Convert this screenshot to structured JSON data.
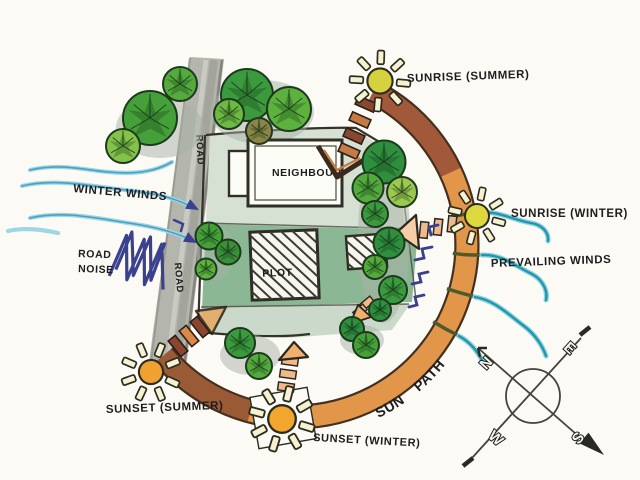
{
  "labels": {
    "winter_winds": "WINTER WINDS",
    "road_noise_line1": "ROAD",
    "road_noise_line2": "NOISE",
    "road_upper": "ROAD",
    "road_lower": "ROAD",
    "neighbour": "NEIGHBOUR",
    "plot": "PLOT",
    "sunrise_summer": "SUNRISE (SUMMER)",
    "sunrise_winter": "SUNRISE (WINTER)",
    "prevailing_winds": "PREVAILING WINDS",
    "sunset_summer": "SUNSET (SUMMER)",
    "sunset_winter": "SUNSET (WINTER)",
    "sun_path": "SUN PATH"
  },
  "compass": {
    "north": "N",
    "east": "E",
    "south": "S",
    "west": "W"
  },
  "icons": {
    "sun": "circle-with-ray-spokes",
    "tree": "sketched-canopy-circle",
    "compass": "crossed-axes-over-circle",
    "wind": "wavy-line-with-arrow",
    "sun_direction_arrow": "ladder-rung-arrow"
  },
  "colors": {
    "paper": "#fbfaf5",
    "ink": "#1d1d1d",
    "road_gray": "#b4b5ad",
    "site_green_light": "#d6e1d3",
    "site_green": "#8cb795",
    "arc_orange": "#e2964a",
    "arc_brown": "#a2593a",
    "sun_yellow": "#d9d53e",
    "sun_orange": "#f0a231",
    "tree_green": "#49a13c",
    "winter_wind_blue": "#8fcfe2",
    "prevailing_wind_teal": "#2fa0b5",
    "pen_navy": "#3a3f8e"
  }
}
